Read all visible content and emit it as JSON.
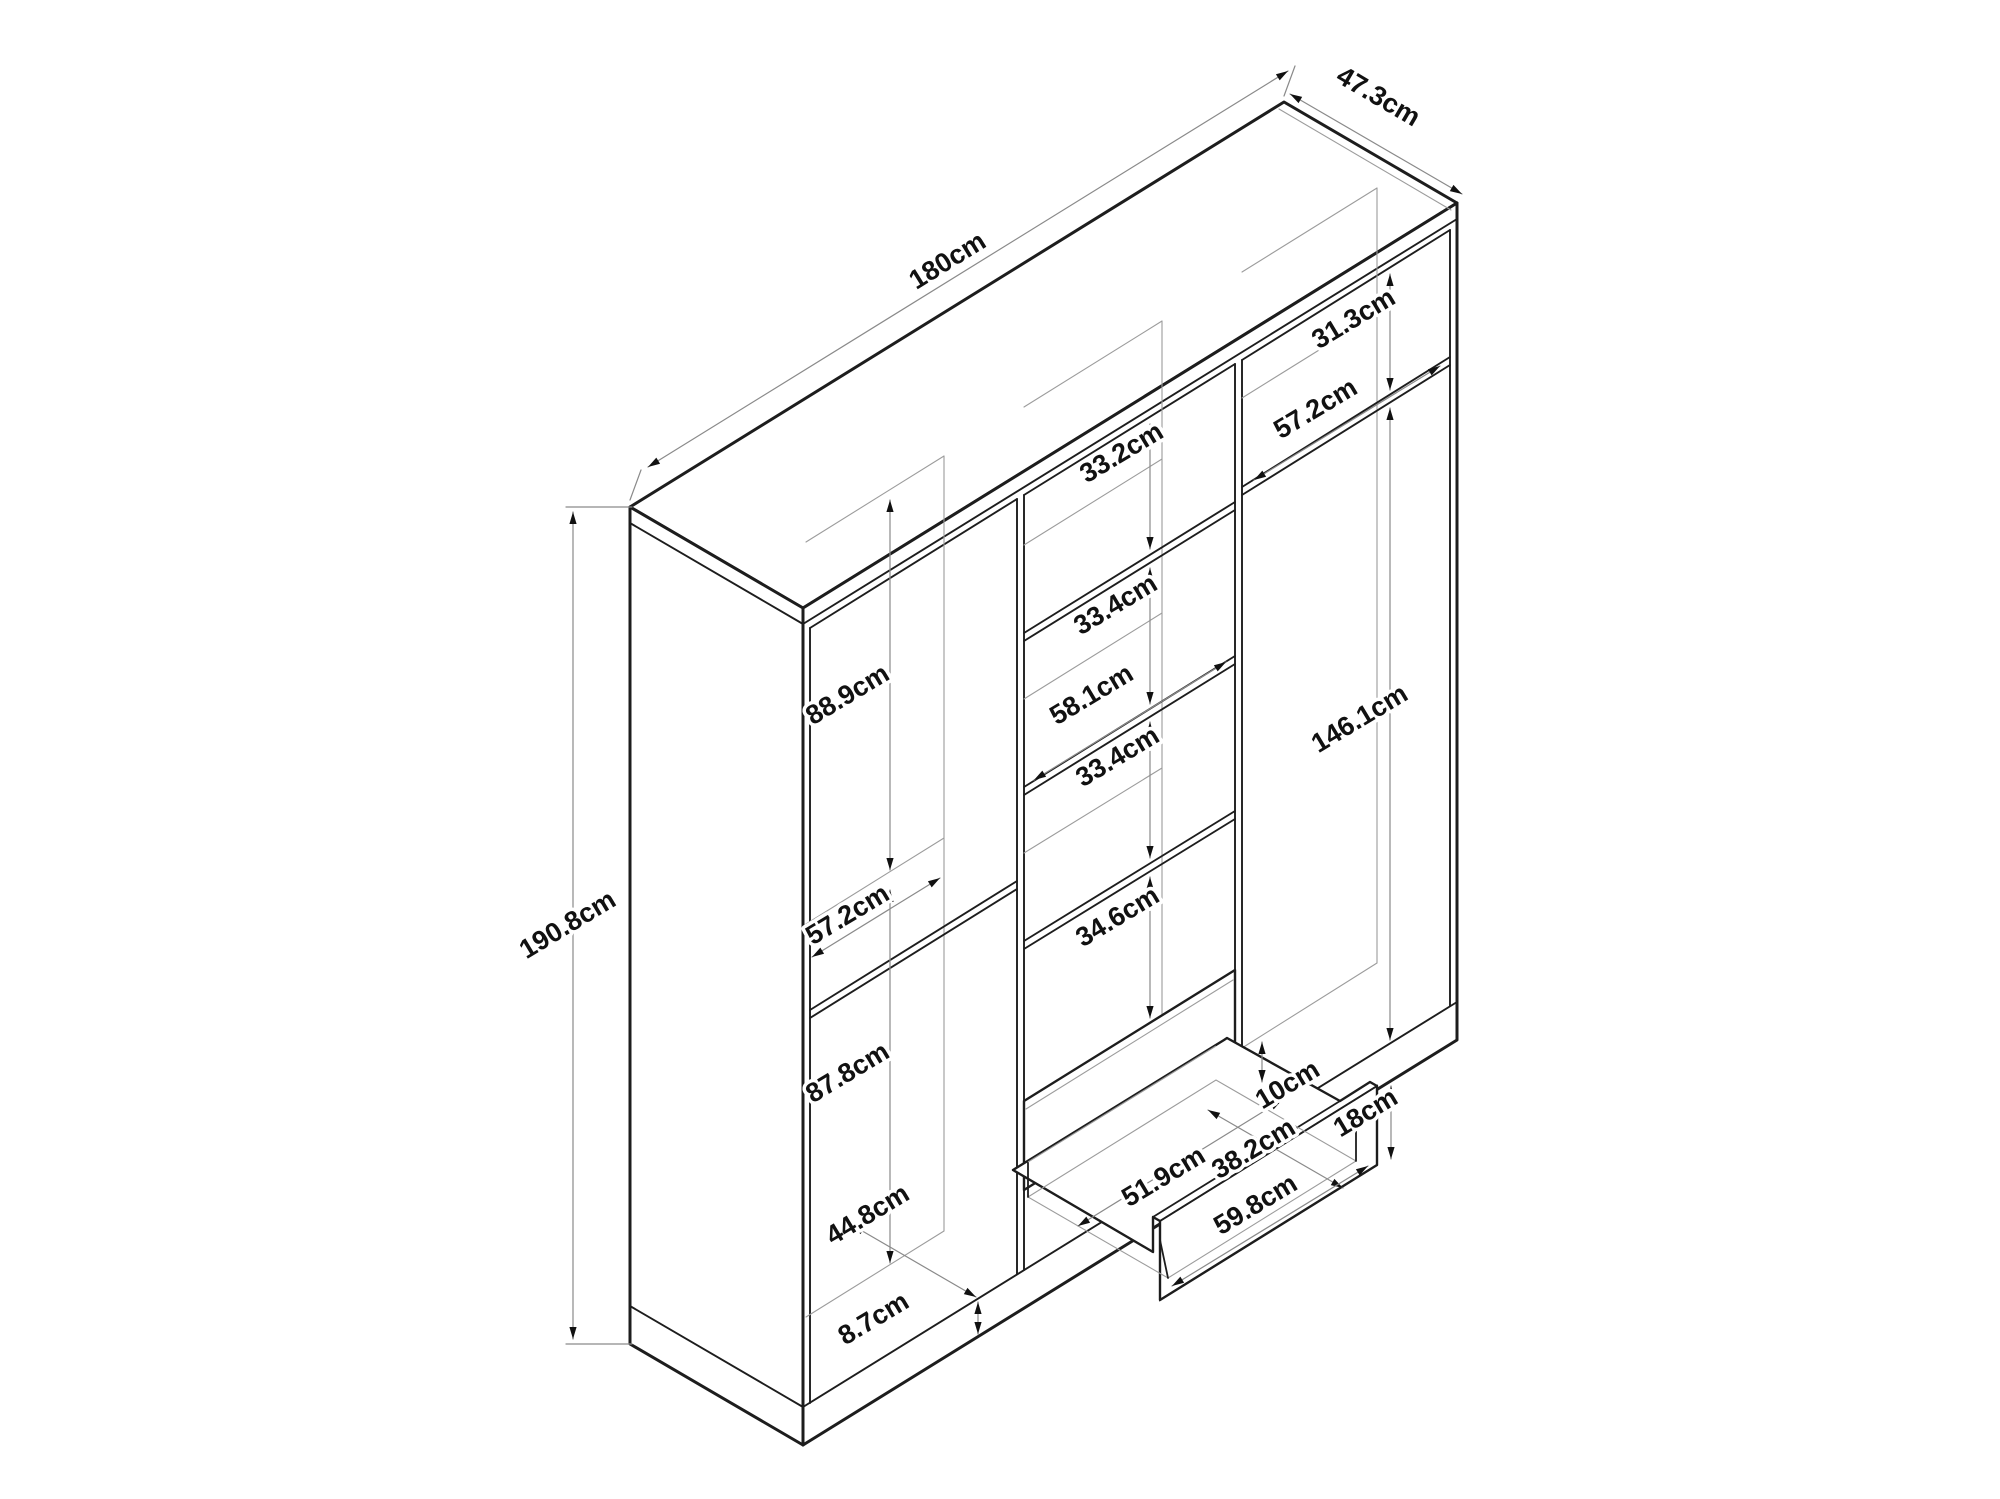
{
  "diagram": {
    "type": "furniture-dimension-line-drawing",
    "object": "wardrobe-with-shelves-and-drawer",
    "unit": "cm",
    "line_color": "#1d1d1d",
    "dim_line_color": "#8a8a8a",
    "background": "#ffffff"
  },
  "dimensions_cm": {
    "overall": {
      "width": 180,
      "depth": 47.3,
      "height": 190.8
    },
    "left_section": {
      "upper_compartment_height": 88.9,
      "shelf_width": 57.2,
      "lower_compartment_height": 87.8,
      "interior_floor_depth": 44.8,
      "base_height": 8.7
    },
    "middle_section": {
      "shelf_width": 58.1,
      "compartment_gaps": [
        33.2,
        33.4,
        33.4,
        34.6
      ]
    },
    "right_section": {
      "top_cubby_height": 31.3,
      "shelf_width": 57.2,
      "hanging_space_height": 146.1
    },
    "drawer": {
      "inner_width": 51.9,
      "inner_depth": 38.2,
      "back_wall_height": 10,
      "front_height": 18,
      "front_width": 59.8
    }
  },
  "labels": [
    {
      "name": "dim-label-180cm",
      "text": "180cm",
      "x": 952,
      "y": 268,
      "rot": -31.7
    },
    {
      "name": "dim-label-47-3cm",
      "text": "47.3cm",
      "x": 1374,
      "y": 104,
      "rot": 30.3
    },
    {
      "name": "dim-label-190-8cm",
      "text": "190.8cm",
      "x": 572,
      "y": 932,
      "rot": -31
    },
    {
      "name": "dim-label-88-9cm",
      "text": "88.9cm",
      "x": 852,
      "y": 702,
      "rot": -31
    },
    {
      "name": "dim-label-57-2cm-left",
      "text": "57.2cm",
      "x": 852,
      "y": 922,
      "rot": -31
    },
    {
      "name": "dim-label-87-8cm",
      "text": "87.8cm",
      "x": 852,
      "y": 1080,
      "rot": -31
    },
    {
      "name": "dim-label-44-8cm",
      "text": "44.8cm",
      "x": 872,
      "y": 1222,
      "rot": -31
    },
    {
      "name": "dim-label-8-7cm",
      "text": "8.7cm",
      "x": 878,
      "y": 1326,
      "rot": -31
    },
    {
      "name": "dim-label-33-2cm",
      "text": "33.2cm",
      "x": 1126,
      "y": 460,
      "rot": -31
    },
    {
      "name": "dim-label-33-4cm-a",
      "text": "33.4cm",
      "x": 1120,
      "y": 612,
      "rot": -31
    },
    {
      "name": "dim-label-58-1cm",
      "text": "58.1cm",
      "x": 1096,
      "y": 702,
      "rot": -31
    },
    {
      "name": "dim-label-33-4cm-b",
      "text": "33.4cm",
      "x": 1122,
      "y": 764,
      "rot": -31
    },
    {
      "name": "dim-label-34-6cm",
      "text": "34.6cm",
      "x": 1122,
      "y": 924,
      "rot": -31
    },
    {
      "name": "dim-label-31-3cm",
      "text": "31.3cm",
      "x": 1358,
      "y": 326,
      "rot": -31
    },
    {
      "name": "dim-label-57-2cm-right",
      "text": "57.2cm",
      "x": 1320,
      "y": 416,
      "rot": -31
    },
    {
      "name": "dim-label-146-1cm",
      "text": "146.1cm",
      "x": 1364,
      "y": 726,
      "rot": -31
    },
    {
      "name": "dim-label-10cm",
      "text": "10cm",
      "x": 1292,
      "y": 1092,
      "rot": -31
    },
    {
      "name": "dim-label-51-9cm",
      "text": "51.9cm",
      "x": 1168,
      "y": 1184,
      "rot": -31
    },
    {
      "name": "dim-label-38-2cm",
      "text": "38.2cm",
      "x": 1258,
      "y": 1156,
      "rot": -31
    },
    {
      "name": "dim-label-18cm",
      "text": "18cm",
      "x": 1370,
      "y": 1120,
      "rot": -31
    },
    {
      "name": "dim-label-59-8cm",
      "text": "59.8cm",
      "x": 1260,
      "y": 1212,
      "rot": -31
    }
  ]
}
